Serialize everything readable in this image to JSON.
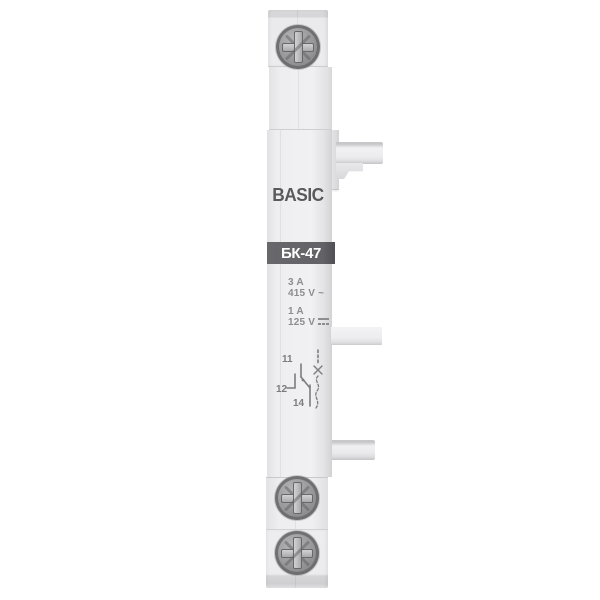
{
  "device": {
    "brand": "BASIC",
    "model": "БК-47",
    "ratings": [
      {
        "current": "3 A",
        "voltage": "415 V ~",
        "voltage_type": "ac"
      },
      {
        "current": "1 A",
        "voltage": "125 V",
        "voltage_type": "dc"
      }
    ],
    "diagram": {
      "type": "changeover-auxiliary-contact-schematic",
      "terminal_top": "11",
      "terminal_left": "12",
      "terminal_bottom": "14"
    },
    "colors": {
      "background": "#ffffff",
      "body": "#ececee",
      "label_band": "#636367",
      "brand_text": "#59595b",
      "spec_text": "#8d8d8f",
      "screw_metal": "#98989a",
      "diagram_line": "#7c7c7e"
    }
  }
}
